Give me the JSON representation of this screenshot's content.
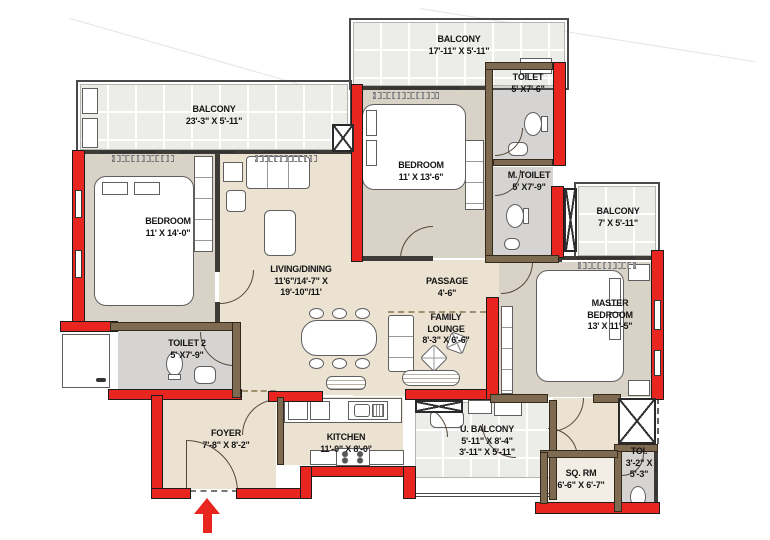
{
  "meta": {
    "type": "apartment-floor-plan"
  },
  "palette": {
    "wall_red": "#e8251f",
    "wall_brown": "#7d6a50",
    "floor_beige": "#ebe2d2",
    "floor_tan": "#d9d2c6",
    "floor_toilet": "#d6d4d2",
    "balcony_tile": "#ececE9"
  },
  "rooms": {
    "balcony_top_left": {
      "name": "BALCONY",
      "dims": [
        "23'-3\" X 5'-11\""
      ]
    },
    "balcony_top_mid": {
      "name": "BALCONY",
      "dims": [
        "17'-11\" X 5'-11\""
      ]
    },
    "toilet": {
      "name": "TOILET",
      "dims": [
        "5' X7'-6\""
      ]
    },
    "m_toilet": {
      "name": "M. TOILET",
      "dims": [
        "5' X7'-9\""
      ]
    },
    "balcony_right": {
      "name": "BALCONY",
      "dims": [
        "7' X 5'-11\""
      ]
    },
    "bedroom_left": {
      "name": "BEDROOM",
      "dims": [
        "11' X 14'-0\""
      ]
    },
    "bedroom_mid": {
      "name": "BEDROOM",
      "dims": [
        "11' X 13'-6\""
      ]
    },
    "living_dining": {
      "name": "LIVING/DINING",
      "dims": [
        "11'6\"/14'-7\" X",
        "19'-10\"/11'"
      ]
    },
    "passage": {
      "name": "PASSAGE",
      "dims": [
        "4'-6\""
      ]
    },
    "family_lounge": {
      "lines": [
        "FAMILY",
        "LOUNGE"
      ],
      "dims": [
        "8'-3\" X 6'-6\""
      ]
    },
    "master_bedroom": {
      "lines": [
        "MASTER",
        "BEDROOM"
      ],
      "dims": [
        "13' X 11'-5\""
      ]
    },
    "toilet_2": {
      "name": "TOILET 2",
      "dims": [
        "5' X7'-9\""
      ]
    },
    "foyer": {
      "name": "FOYER",
      "dims": [
        "7'-8\" X 8'-2\""
      ]
    },
    "kitchen": {
      "name": "KITCHEN",
      "dims": [
        "11'-0\" X 8'-0\""
      ]
    },
    "u_balcony": {
      "name": "U. BALCONY",
      "dims": [
        "5'-11\" X 8'-4\"",
        "3'-11\" X 5'-11\""
      ]
    },
    "sq_rm": {
      "name": "SQ. RM",
      "dims": [
        "6'-6\" X 6'-7\""
      ]
    },
    "toi": {
      "name": "TOI.",
      "dims": [
        "3'-2\" X",
        "5'-3\""
      ]
    }
  }
}
